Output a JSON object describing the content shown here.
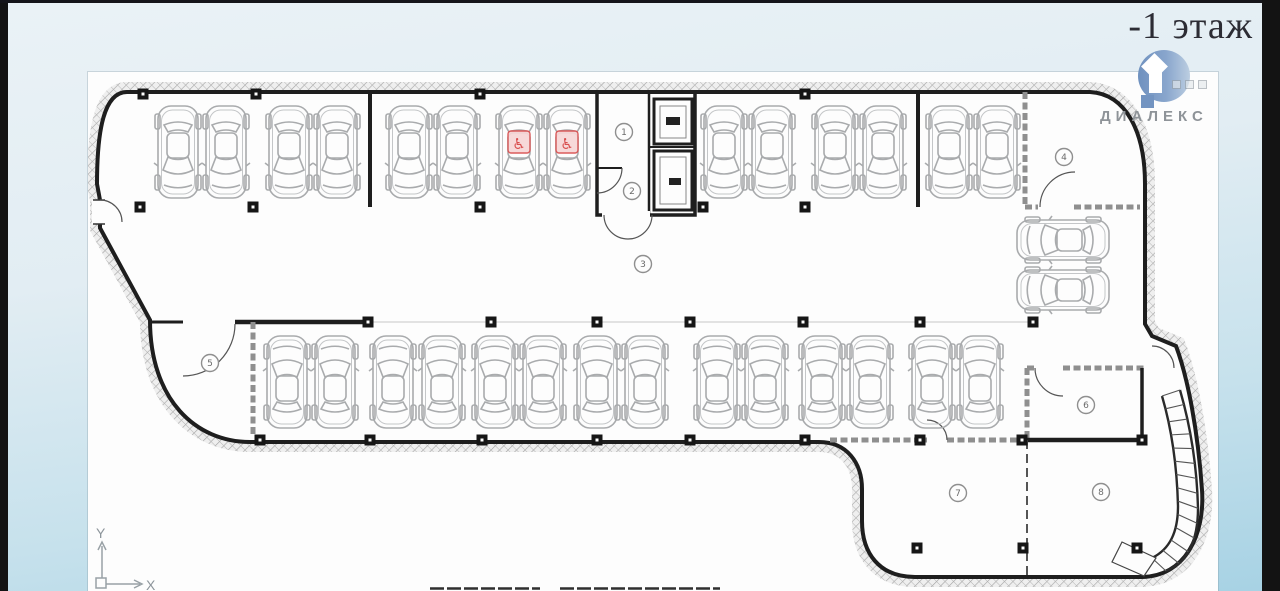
{
  "header": {
    "floor_label": "-1 этаж"
  },
  "logo": {
    "name": "ДИАЛЕКС"
  },
  "plan": {
    "axis": {
      "x": "X",
      "y": "Y"
    },
    "accessible_symbol": "♿",
    "parking": {
      "total_spaces": 30,
      "accessible_spaces": 2
    },
    "room_labels": [
      {
        "n": "1",
        "x": 536,
        "y": 60
      },
      {
        "n": "2",
        "x": 544,
        "y": 119
      },
      {
        "n": "3",
        "x": 555,
        "y": 192
      },
      {
        "n": "4",
        "x": 976,
        "y": 85
      },
      {
        "n": "5",
        "x": 122,
        "y": 291
      },
      {
        "n": "6",
        "x": 998,
        "y": 333
      },
      {
        "n": "7",
        "x": 870,
        "y": 421
      },
      {
        "n": "8",
        "x": 1013,
        "y": 420
      }
    ],
    "cars": [
      [
        90,
        80,
        180,
        0
      ],
      [
        138,
        80,
        180,
        0
      ],
      [
        201,
        80,
        180,
        0
      ],
      [
        249,
        80,
        180,
        0
      ],
      [
        321,
        80,
        180,
        0
      ],
      [
        369,
        80,
        180,
        0
      ],
      [
        431,
        80,
        180,
        1
      ],
      [
        479,
        80,
        180,
        1
      ],
      [
        636,
        80,
        180,
        0
      ],
      [
        684,
        80,
        180,
        0
      ],
      [
        747,
        80,
        180,
        0
      ],
      [
        795,
        80,
        180,
        0
      ],
      [
        861,
        80,
        180,
        0
      ],
      [
        909,
        80,
        180,
        0
      ],
      [
        199,
        310,
        0,
        0
      ],
      [
        247,
        310,
        0,
        0
      ],
      [
        305,
        310,
        0,
        0
      ],
      [
        354,
        310,
        0,
        0
      ],
      [
        407,
        310,
        0,
        0
      ],
      [
        455,
        310,
        0,
        0
      ],
      [
        509,
        310,
        0,
        0
      ],
      [
        557,
        310,
        0,
        0
      ],
      [
        629,
        310,
        0,
        0
      ],
      [
        677,
        310,
        0,
        0
      ],
      [
        734,
        310,
        0,
        0
      ],
      [
        782,
        310,
        0,
        0
      ],
      [
        844,
        310,
        0,
        0
      ],
      [
        892,
        310,
        0,
        0
      ],
      [
        975,
        168,
        -90,
        0
      ],
      [
        975,
        218,
        -90,
        0
      ]
    ],
    "columns": [
      [
        55,
        22
      ],
      [
        168,
        22
      ],
      [
        392,
        22
      ],
      [
        717,
        22
      ],
      [
        52,
        135
      ],
      [
        165,
        135
      ],
      [
        392,
        135
      ],
      [
        615,
        135
      ],
      [
        717,
        135
      ],
      [
        280,
        250
      ],
      [
        403,
        250
      ],
      [
        509,
        250
      ],
      [
        602,
        250
      ],
      [
        715,
        250
      ],
      [
        832,
        250
      ],
      [
        945,
        250
      ],
      [
        172,
        368
      ],
      [
        282,
        368
      ],
      [
        394,
        368
      ],
      [
        509,
        368
      ],
      [
        602,
        368
      ],
      [
        717,
        368
      ],
      [
        832,
        368
      ],
      [
        934,
        368
      ],
      [
        1054,
        368
      ],
      [
        829,
        476
      ],
      [
        935,
        476
      ],
      [
        1049,
        476
      ]
    ]
  },
  "colors": {
    "accent_red": "#d94f4f",
    "wall": "#1e1e1e",
    "car_outline": "#a9abad",
    "logo_blue": "#7394c1",
    "background_top": "#eaf2f6",
    "background_bottom": "#a7d2e4"
  }
}
